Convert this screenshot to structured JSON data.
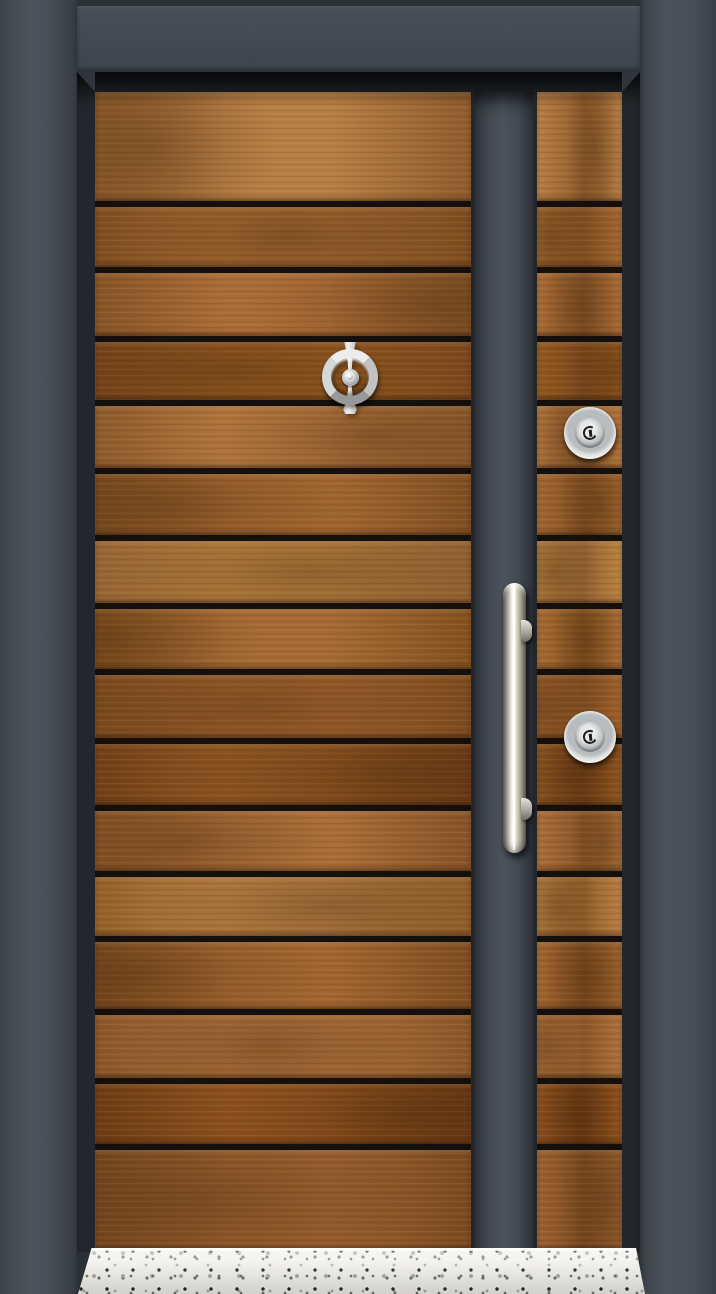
{
  "scene": {
    "description": "Steel security entry door photo: horizontal walnut wood slats separated by black grooves, anthracite grey frame and vertical mullion strip, chrome ring door knocker with centre peephole, two round chrome lock cylinders, long vertical satin-steel pull handle, speckled white terrazzo threshold sill",
    "canvas": {
      "width": 716,
      "height": 1294
    }
  },
  "palette": {
    "wall-top": "#2c3137",
    "frame-face": "#434951",
    "frame-reveal": "#2c3036",
    "leaf-bg": "#24282d",
    "plank-gap": "#15100b",
    "wood-light": "#b5793f",
    "wood-dark": "#7a481c",
    "chrome-light": "#f4f3ec",
    "chrome-dark": "#6f6d63",
    "terrazzo-base": "#f0efea",
    "speck-dark": "#28282c",
    "speck-mid": "#6f6f6d",
    "speck-light": "#a9a9a5"
  },
  "frame": {
    "top_strip_h": 6,
    "wall_notch": {
      "x": 0,
      "y": 6,
      "w": 8,
      "h": 10
    },
    "jamb_left": {
      "x": 0,
      "w": 77
    },
    "jamb_right": {
      "x": 640,
      "w": 76
    },
    "header": {
      "x": 77,
      "y": 6,
      "w": 563,
      "h": 66
    },
    "chamfer_size": {
      "w": 18,
      "h": 20
    },
    "reveal": {
      "x": 77,
      "w": 563,
      "top": 72,
      "bottom": 1252
    }
  },
  "leaf": {
    "wood_top": 92,
    "wood_bottom": 1250,
    "left_col": {
      "x": 95,
      "w": 376
    },
    "mullion": {
      "x": 475,
      "w": 58
    },
    "right_col": {
      "x": 537,
      "w": 85
    }
  },
  "planks": {
    "gap_h": 6,
    "gap_centers": [
      204,
      270,
      339,
      403,
      471,
      538,
      606,
      672,
      741,
      808,
      874,
      939,
      1012,
      1081,
      1147
    ],
    "tones": [
      [
        "#b77e44",
        "#8f5c2c"
      ],
      [
        "#a1672f",
        "#7d4c1f"
      ],
      [
        "#aa6c36",
        "#865426"
      ],
      [
        "#93591f",
        "#7a471c"
      ],
      [
        "#b0743c",
        "#8d5a2a"
      ],
      [
        "#a36730",
        "#7f4e21"
      ],
      [
        "#b8813f",
        "#966433"
      ],
      [
        "#a56a33",
        "#83511f"
      ],
      [
        "#9d602c",
        "#7b4a1e"
      ],
      [
        "#8e5420",
        "#713f17"
      ],
      [
        "#aa6e38",
        "#875326"
      ],
      [
        "#b67e42",
        "#936029"
      ],
      [
        "#a26630",
        "#7f4d20"
      ],
      [
        "#ad703a",
        "#8a5628"
      ],
      [
        "#8b4f1d",
        "#6d3c14"
      ],
      [
        "#9c6130",
        "#7a4a20"
      ]
    ]
  },
  "hardware": {
    "knocker": {
      "cx": 350,
      "cy": 377,
      "ring_d": 56,
      "ring_thickness": 9,
      "spine_w": 24,
      "spine_top": 342,
      "spine_bottom": 414,
      "peephole_d": 17
    },
    "lock_upper": {
      "cx": 590,
      "cy": 433,
      "d": 52
    },
    "lock_lower": {
      "cx": 590,
      "cy": 737,
      "d": 52
    },
    "handle": {
      "x": 503,
      "y": 583,
      "w": 23,
      "h": 270,
      "standoff_ys": [
        620,
        798
      ],
      "standoff_h": 22
    }
  },
  "sill": {
    "x": 78,
    "y": 1248,
    "w": 567,
    "h": 46
  }
}
